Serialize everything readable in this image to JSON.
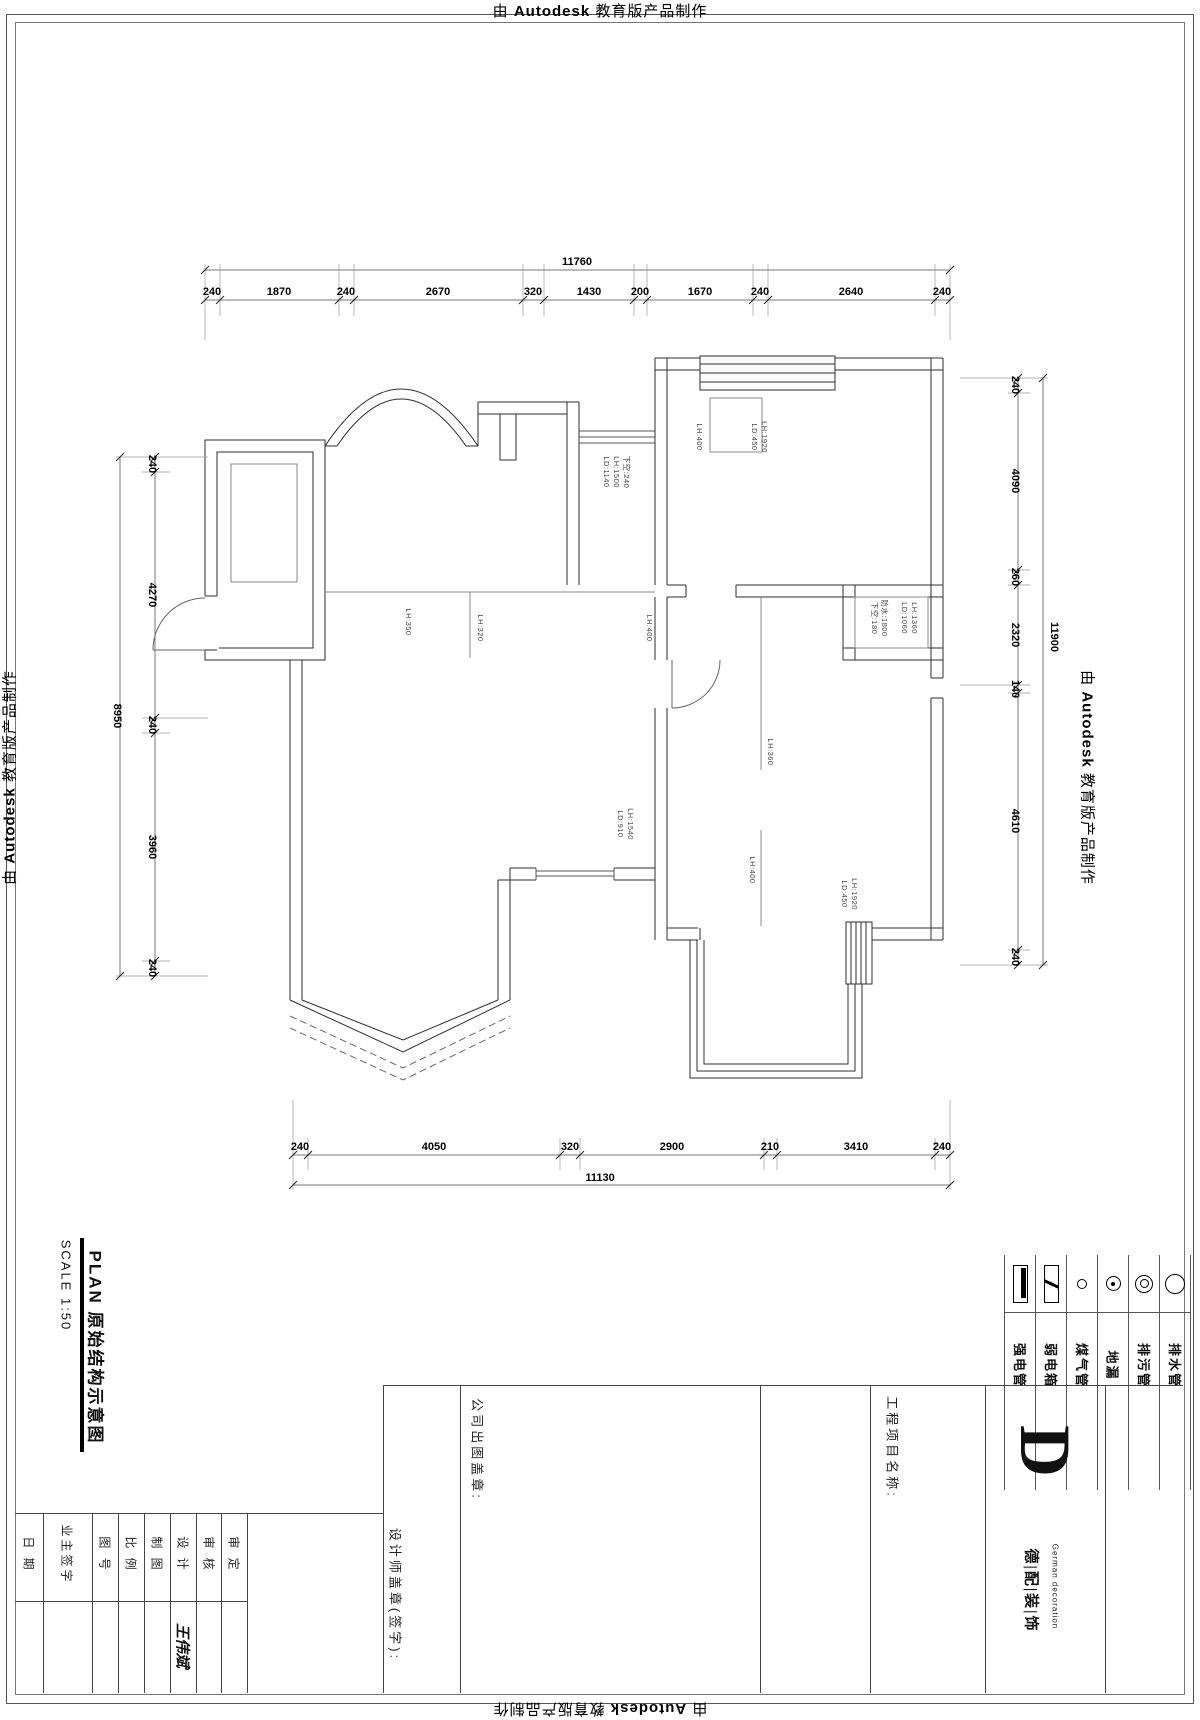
{
  "stamp": {
    "prefix": "由",
    "brand": "Autodesk",
    "suffix": "教育版产品制作"
  },
  "title": {
    "plan": "PLAN  原始结构示意图",
    "scale": "SCALE    1:50"
  },
  "dims": {
    "top": {
      "total": "11760",
      "segments": [
        "240",
        "1870",
        "240",
        "2670",
        "320",
        "1430",
        "200",
        "1670",
        "240",
        "2640",
        "240"
      ]
    },
    "bottom": {
      "total": "11130",
      "segments": [
        "240",
        "4050",
        "320",
        "2900",
        "210",
        "3410",
        "240"
      ]
    },
    "left": {
      "total": "8950",
      "segments": [
        "240",
        "4270",
        "240",
        "3960",
        "240"
      ]
    },
    "right": {
      "total": "11900",
      "segments": [
        "240",
        "4090",
        "260",
        "2320",
        "140",
        "4610",
        "240"
      ]
    }
  },
  "plan_labels": [
    "LH:350",
    "LH:320",
    "LH:400",
    "LD:1140",
    "LH:1500",
    "下空:240",
    "LH:400",
    "LD:450",
    "LH:1920",
    "下空:180",
    "防水:1800",
    "LD:1060",
    "LH:1360",
    "LH:360",
    "LD:910",
    "LH:1540",
    "LH:400",
    "LD:450",
    "LH:1920"
  ],
  "legend": {
    "items": [
      {
        "label": "强电管",
        "symbol": "filled-rect"
      },
      {
        "label": "弱电箱",
        "symbol": "diagonal-rect"
      },
      {
        "label": "煤气管",
        "symbol": "small-circle"
      },
      {
        "label": "地漏",
        "symbol": "dot-circle"
      },
      {
        "label": "排污管",
        "symbol": "double-circle"
      },
      {
        "label": "排水管",
        "symbol": "circle"
      }
    ]
  },
  "titleblock": {
    "date": "日 期",
    "owner_sign": "业主签字",
    "drawing_no": "图 号",
    "scale": "比 例",
    "drafter": "制 图",
    "designer": "设 计",
    "checker": "审 核",
    "approver": "审 定",
    "drafter_signature": "王伟斌",
    "designer_seal": "设计师盖章(签字):",
    "company_seal": "公司出图盖章:",
    "project_name": "工程项目名称:",
    "logo_letter": "D",
    "logo_cn": "德|配|装|饰",
    "logo_en": "German decoration"
  }
}
